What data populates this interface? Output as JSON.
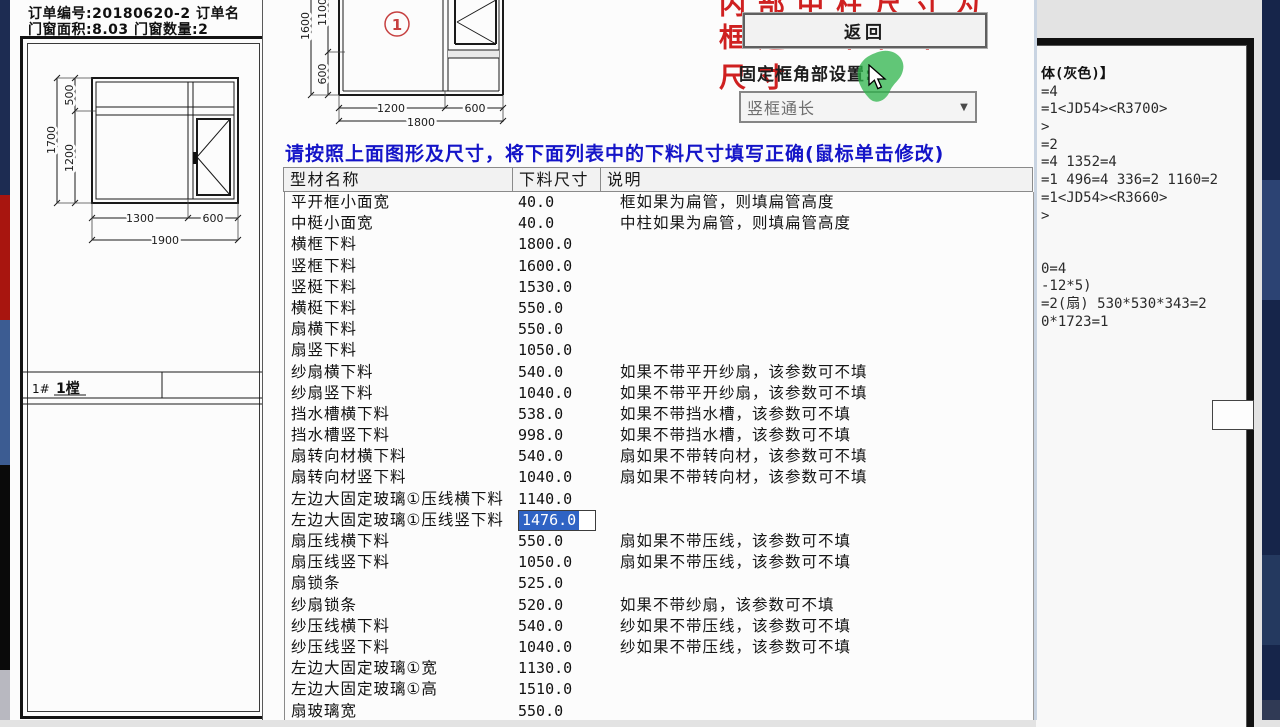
{
  "left_edge_colors": {
    "top_navy": "#1d2c52",
    "red": "#a8150f",
    "steel_blue": "#3c5c92",
    "black": "#0a0a0a",
    "bottom_gray": "#b8b8c0"
  },
  "right_edge_colors": {
    "base": "#16254a",
    "patch1": "#2c4373",
    "patch2": "#24395f",
    "patch3": "#303a55"
  },
  "left_panel": {
    "order_line1": "订单编号:20180620-2 订单名",
    "order_line2": "门窗面积:8.03 门窗数量:2",
    "drawing_dims": {
      "top_h": "500",
      "total_h": "1700",
      "lower_h": "1200",
      "w1": "1300",
      "w2": "600",
      "total_w": "1900"
    },
    "row_id": "1#",
    "row_qty": "1樘"
  },
  "dialog": {
    "diagram_dims": {
      "left_total": "1600",
      "upper": "1100",
      "lower": "600",
      "bw1": "1200",
      "bw2": "600",
      "btotal": "1800"
    },
    "pane_digit": "1",
    "red_note_line1": "内部中柱尺寸为",
    "red_note_line2": "框边到中柱中心",
    "red_note_line3": "尺寸",
    "back_button": "返回",
    "corner_setting_label": "固定框角部设置:",
    "dropdown_value": "竖框通长",
    "dropdown_arrow": "▼",
    "instruction": "请按照上面图形及尺寸，将下面列表中的下料尺寸填写正确(鼠标单击修改)",
    "table": {
      "headers": [
        "型材名称",
        "下料尺寸",
        "说明"
      ],
      "selection_color": "#2f63c4",
      "rows": [
        {
          "name": "平开框小面宽",
          "value": "40.0",
          "note": "框如果为扁管，则填扁管高度"
        },
        {
          "name": "中梃小面宽",
          "value": "40.0",
          "note": "中柱如果为扁管，则填扁管高度"
        },
        {
          "name": "横框下料",
          "value": "1800.0",
          "note": ""
        },
        {
          "name": "竖框下料",
          "value": "1600.0",
          "note": ""
        },
        {
          "name": "竖梃下料",
          "value": "1530.0",
          "note": ""
        },
        {
          "name": "横梃下料",
          "value": "550.0",
          "note": ""
        },
        {
          "name": "扇横下料",
          "value": "550.0",
          "note": ""
        },
        {
          "name": "扇竖下料",
          "value": "1050.0",
          "note": ""
        },
        {
          "name": "纱扇横下料",
          "value": "540.0",
          "note": "如果不带平开纱扇，该参数可不填"
        },
        {
          "name": "纱扇竖下料",
          "value": "1040.0",
          "note": "如果不带平开纱扇，该参数可不填"
        },
        {
          "name": "挡水槽横下料",
          "value": "538.0",
          "note": "如果不带挡水槽，该参数可不填"
        },
        {
          "name": "挡水槽竖下料",
          "value": "998.0",
          "note": "如果不带挡水槽，该参数可不填"
        },
        {
          "name": "扇转向材横下料",
          "value": "540.0",
          "note": "扇如果不带转向材，该参数可不填"
        },
        {
          "name": "扇转向材竖下料",
          "value": "1040.0",
          "note": "扇如果不带转向材，该参数可不填"
        },
        {
          "name": "左边大固定玻璃①压线横下料",
          "value": "1140.0",
          "note": ""
        },
        {
          "name": "左边大固定玻璃①压线竖下料",
          "value": "1476.0",
          "note": "",
          "selected": true
        },
        {
          "name": "扇压线横下料",
          "value": "550.0",
          "note": "扇如果不带压线，该参数可不填"
        },
        {
          "name": "扇压线竖下料",
          "value": "1050.0",
          "note": "扇如果不带压线，该参数可不填"
        },
        {
          "name": "扇锁条",
          "value": "525.0",
          "note": ""
        },
        {
          "name": "纱扇锁条",
          "value": "520.0",
          "note": "如果不带纱扇，该参数可不填"
        },
        {
          "name": "纱压线横下料",
          "value": "540.0",
          "note": "纱如果不带压线，该参数可不填"
        },
        {
          "name": "纱压线竖下料",
          "value": "1040.0",
          "note": "纱如果不带压线，该参数可不填"
        },
        {
          "name": "左边大固定玻璃①宽",
          "value": "1130.0",
          "note": ""
        },
        {
          "name": "左边大固定玻璃①高",
          "value": "1510.0",
          "note": ""
        },
        {
          "name": "扇玻璃宽",
          "value": "550.0",
          "note": ""
        }
      ]
    }
  },
  "right_panel": {
    "lines": [
      "体(灰色)】",
      "=4",
      "=1<JD54><R3700>",
      ">",
      "=2",
      "=4 1352=4",
      "=1 496=4 336=2 1160=2",
      "=1<JD54><R3660>",
      ">",
      "",
      "",
      "0=4",
      "-12*5)",
      "=2(扇) 530*530*343=2",
      "0*1723=1"
    ]
  }
}
